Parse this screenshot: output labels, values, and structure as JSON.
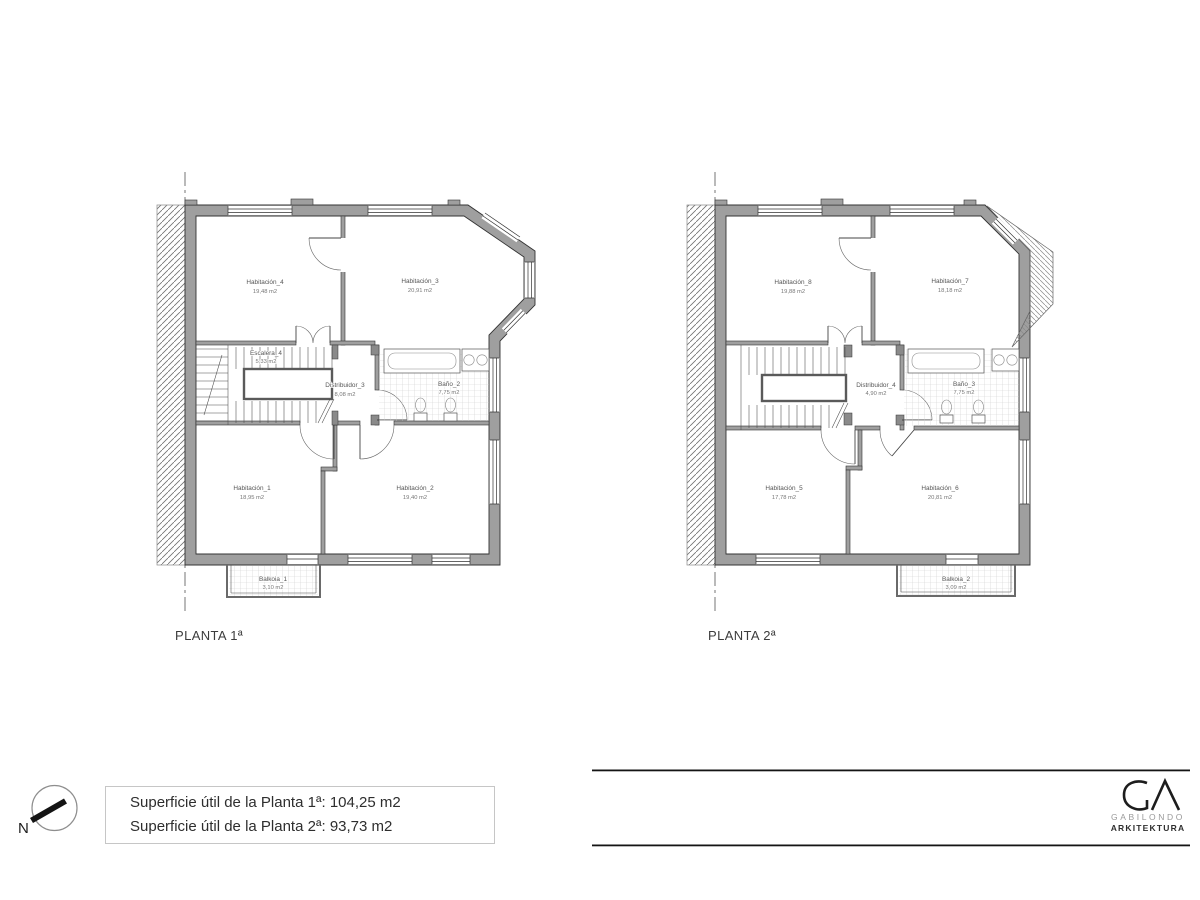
{
  "plans": [
    {
      "title": "PLANTA 1ª",
      "rooms": [
        {
          "name": "Habitación_4",
          "area": "19,48 m2"
        },
        {
          "name": "Habitación_3",
          "area": "20,91 m2"
        },
        {
          "name": "Escalera_4",
          "area": "5,33 m2"
        },
        {
          "name": "Distribuidor_3",
          "area": "8,08 m2"
        },
        {
          "name": "Baño_2",
          "area": "7,75 m2"
        },
        {
          "name": "Habitación_1",
          "area": "18,95 m2"
        },
        {
          "name": "Habitación_2",
          "area": "19,40 m2"
        },
        {
          "name": "Balkoia_1",
          "area": "3,10 m2"
        }
      ]
    },
    {
      "title": "PLANTA 2ª",
      "rooms": [
        {
          "name": "Habitación_8",
          "area": "19,88 m2"
        },
        {
          "name": "Habitación_7",
          "area": "18,18 m2"
        },
        {
          "name": "Distribuidor_4",
          "area": "4,90 m2"
        },
        {
          "name": "Baño_3",
          "area": "7,75 m2"
        },
        {
          "name": "Habitación_5",
          "area": "17,78 m2"
        },
        {
          "name": "Habitación_6",
          "area": "20,81 m2"
        },
        {
          "name": "Balkoia_2",
          "area": "3,09 m2"
        }
      ]
    }
  ],
  "summary": {
    "line1": "Superficie útil de la Planta 1ª: 104,25 m2",
    "line2": "Superficie útil de la Planta 2ª: 93,73 m2"
  },
  "compass": {
    "label": "N"
  },
  "logo": {
    "name": "GABILONDO",
    "subtitle": "ARKITEKTURA"
  },
  "colors": {
    "wall_gray": "#9f9f9f",
    "line_black": "#1a1a1a",
    "hatch_gray": "#707070"
  }
}
